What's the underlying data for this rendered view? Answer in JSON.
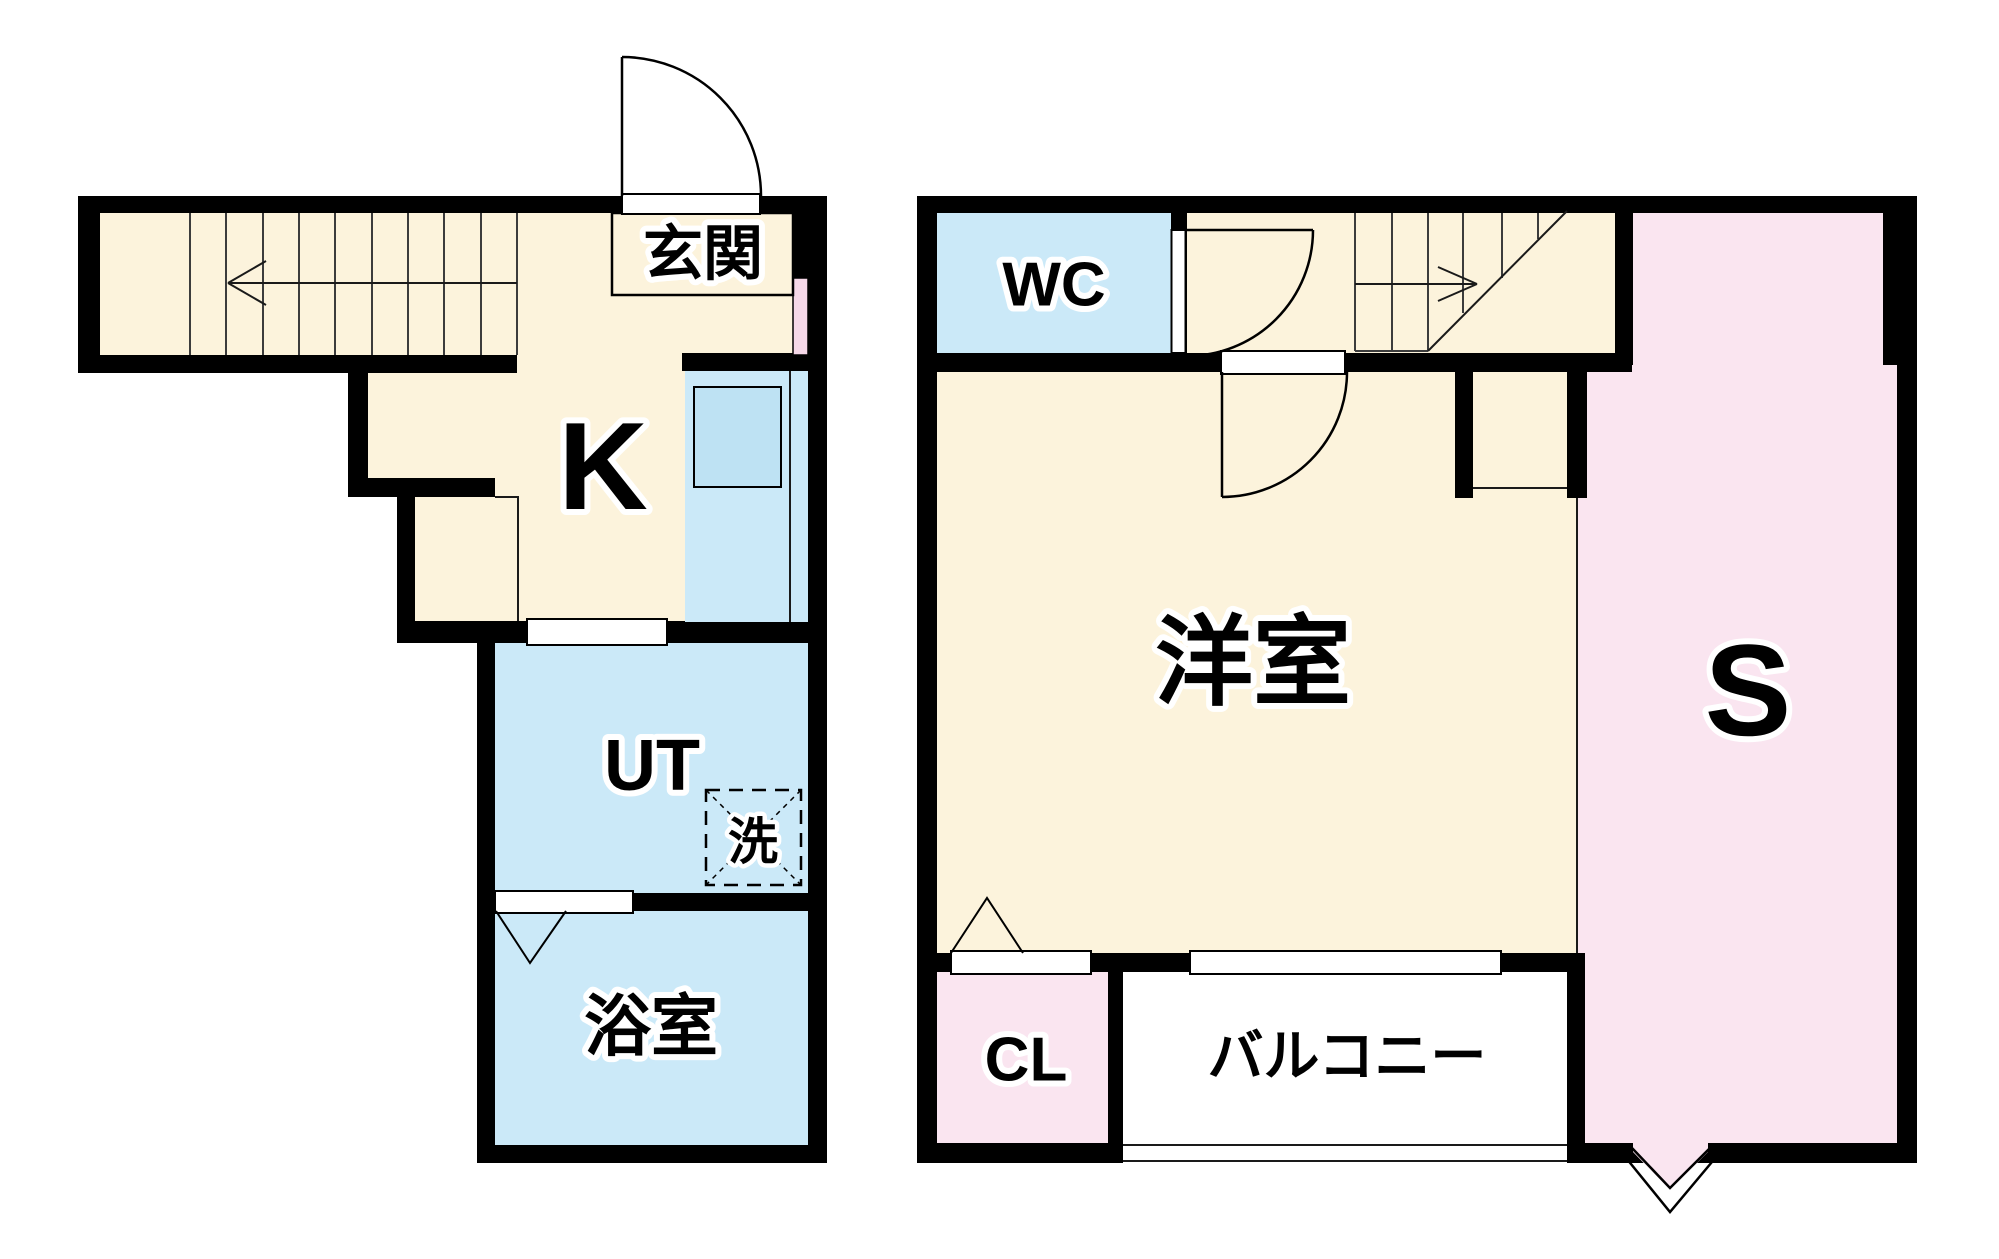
{
  "colors": {
    "cream": "#FCF3DC",
    "blue": "#CBE9F8",
    "sink": "#BEE2F3",
    "pink": "#FAE5F0",
    "windowpink": "#F6D8E8",
    "wall": "#000000"
  },
  "floor1": {
    "entrance": "玄関",
    "kitchen": "K",
    "utility": "UT",
    "washer": "洗",
    "bathroom": "浴室"
  },
  "floor2": {
    "toilet": "WC",
    "western_room": "洋室",
    "storage": "S",
    "closet": "CL",
    "balcony": "バルコニー"
  }
}
